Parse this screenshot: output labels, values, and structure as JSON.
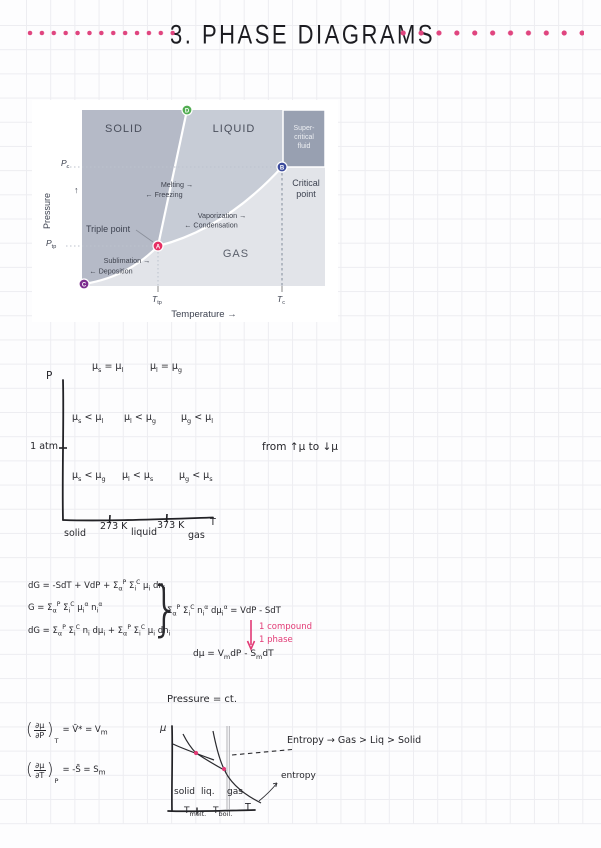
{
  "colors": {
    "accent_pink": "#e0457f",
    "annotation_pink": "#e23a75",
    "ink": "#26262b",
    "grid_line": "#ededf1",
    "solid_region": "#b5bac7",
    "liquid_region": "#c7ccd6",
    "gas_region": "#e2e4e9",
    "supercritical_region": "#98a0b1",
    "point_a": "#e62e63",
    "point_b": "#3c4b9d",
    "point_c": "#7c2d8e",
    "point_d": "#52ad52"
  },
  "title": {
    "text": "3. PHASE DIAGRAMS"
  },
  "phase_diagram": {
    "regions": {
      "solid": "SOLID",
      "liquid": "LIQUID",
      "gas": "GAS",
      "supercritical": [
        "Super-",
        "critical",
        "fluid"
      ]
    },
    "labels": {
      "critical_point": [
        "Critical",
        "point"
      ],
      "triple_point": "Triple point",
      "melting": "Melting →",
      "freezing": "← Freezing",
      "vaporization": "Vaporization →",
      "condensation": "← Condensation",
      "sublimation": "Sublimation →",
      "deposition": "← Deposition"
    },
    "points": {
      "a": "A",
      "b": "B",
      "c": "C",
      "d": "D"
    },
    "axes": {
      "pressure": "Pressure",
      "pressure_arrow": "↑",
      "temperature": "Temperature →",
      "p_c": {
        "base": "P",
        "sub": "c"
      },
      "p_tp": {
        "base": "P",
        "sub": "tp"
      },
      "t_tp": {
        "base": "T",
        "sub": "tp"
      },
      "t_c": {
        "base": "T",
        "sub": "c"
      }
    }
  },
  "mu_graph": {
    "p_label": "P",
    "one_atm": "1 atm",
    "t_label": "T",
    "row_equal": [
      "μ_{s} = μ_{l}",
      "μ_{l} = μ_{g}"
    ],
    "row_high_p": [
      "μ_{s} < μ_{l}",
      "μ_{l} < μ_{g}",
      "μ_{g} < μ_{l}"
    ],
    "row_low_p": [
      "μ_{s} < μ_{g}",
      "μ_{l} < μ_{s}",
      "μ_{g} < μ_{s}"
    ],
    "x_labels": [
      "solid",
      "273 K",
      "liquid",
      "373 K",
      "gas"
    ],
    "note": "from  ↑μ  to  ↓μ"
  },
  "equations": {
    "dg_total": "dG = -SdT + VdP + Σ_{α}^{P} Σ_{i}^{C} μ_{i} dn_{i}",
    "g_sum": "G = Σ_{α}^{P} Σ_{i}^{C} μ_{i}^{α} n_{i}^{α}",
    "dg_expanded": "dG = Σ_{α}^{P} Σ_{i}^{C} n_{i} dμ_{i} + Σ_{α}^{P} Σ_{i}^{C} μ_{i} dn_{i}",
    "brace": "}",
    "gibbs_duhem": "Σ_{α}^{P} Σ_{i}^{C} n_{i}^{α} dμ_{i}^{α} = VdP - SdT",
    "condition_1": "1 compound",
    "condition_2": "1 phase",
    "dmu": "dμ = V_{m}dP - S_{m}dT"
  },
  "bottom": {
    "graph_title": "Pressure = ct.",
    "deriv_p": {
      "num": "∂μ",
      "den": "∂P",
      "sub": "T",
      "rhs": "= V̄* = V_{m}"
    },
    "deriv_t": {
      "num": "∂μ",
      "den": "∂T",
      "sub": "P",
      "rhs": "= -S̄ = S_{m}"
    },
    "mu_label": "μ",
    "phases": [
      "solid",
      "liq.",
      "gas"
    ],
    "t_melt": {
      "base": "T",
      "sub": "melt."
    },
    "t_boil": {
      "base": "T",
      "sub": "boil."
    },
    "t_label": "T",
    "entropy_pointer": "entropy",
    "entropy_note": "Entropy → Gas > Liq > Solid"
  }
}
